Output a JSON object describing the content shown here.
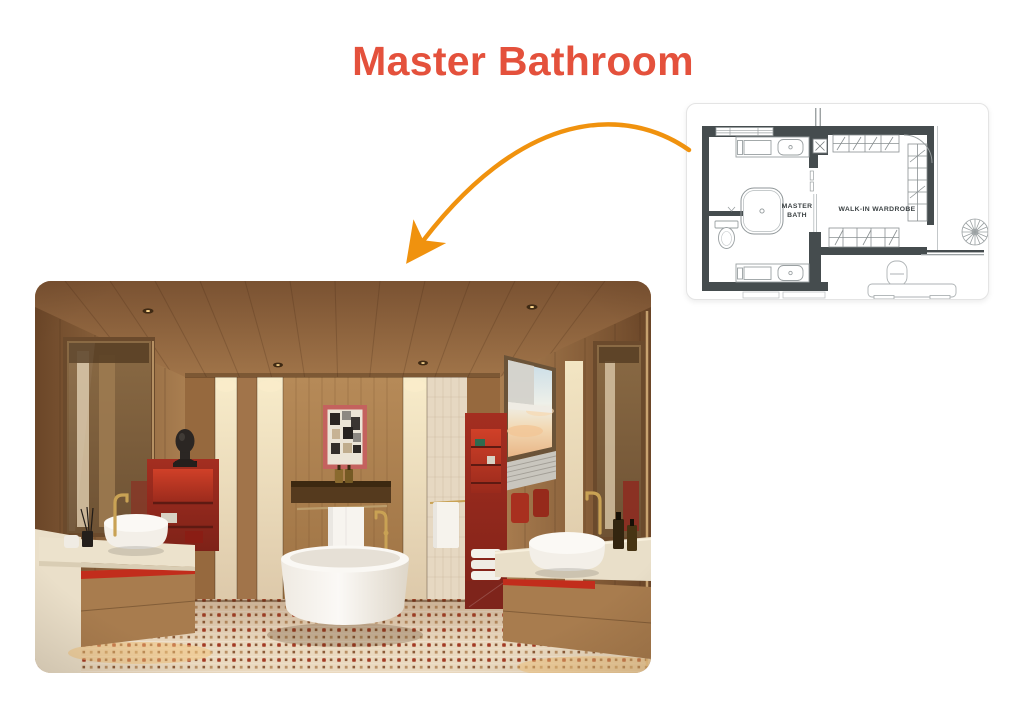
{
  "page": {
    "background": "#ffffff",
    "title": "Master Bathroom",
    "title_color": "#e4513c"
  },
  "arrow": {
    "color": "#f0920e",
    "style": "curved, pointing from floor plan to photo"
  },
  "floor_plan": {
    "card_background": "#ffffff",
    "card_border": "#e4e4e4",
    "wall_color": "#454c4e",
    "fixture_line_color": "#9aa0a2",
    "label_color": "#3c4244",
    "rooms": [
      {
        "name": "MASTER BATH",
        "lines": [
          "MASTER",
          "BATH"
        ]
      },
      {
        "name": "WALK-IN WARDROBE",
        "lines": [
          "WALK-IN WARDROBE"
        ]
      }
    ],
    "symbols": [
      "bathtub",
      "vanity-sink-top",
      "vanity-sink-bottom",
      "toilet",
      "window",
      "shower-square",
      "wardrobe-hanging-rails",
      "entry-door-arc",
      "spiral-staircase",
      "railing",
      "console-furniture"
    ]
  },
  "photo": {
    "subject": "master bathroom interior rendering",
    "palette": {
      "wood": "#a87c4e",
      "wood_dark": "#6b4628",
      "cream_tile": "#ead9bf",
      "accent_red": "#a42e20",
      "accent_red_bright": "#c22d1c",
      "tub_white": "#f6f3ee",
      "brass": "#c9a254",
      "floor_dot_red": "#a33a24"
    }
  }
}
